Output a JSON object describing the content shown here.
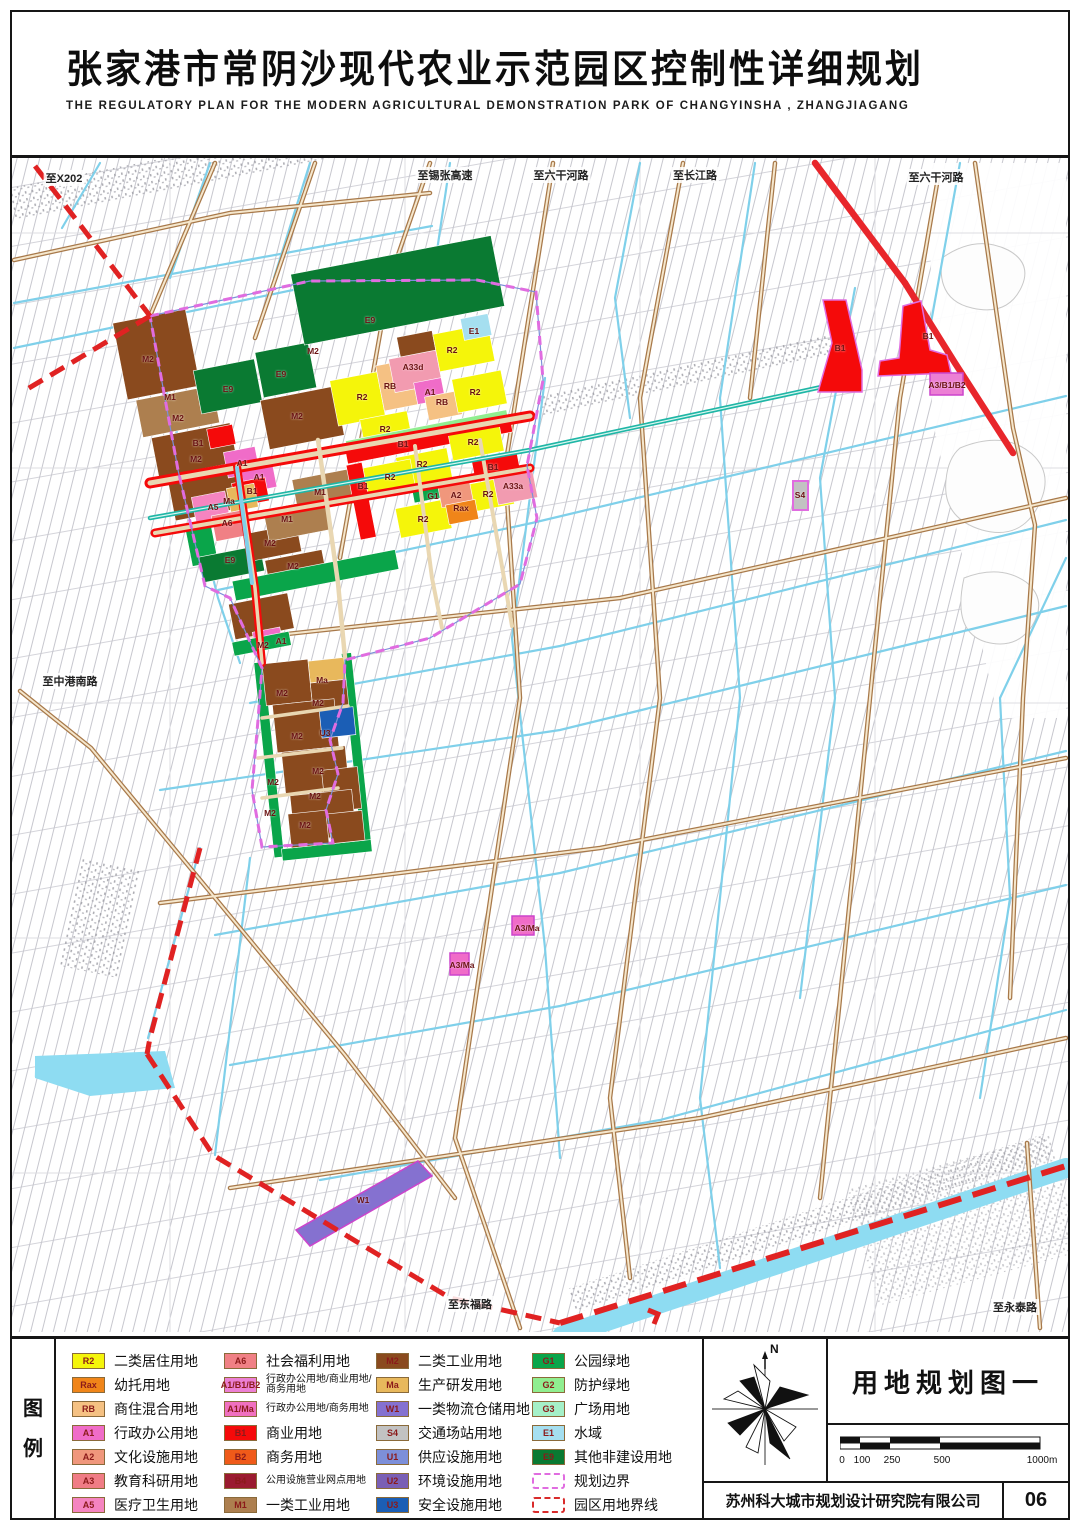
{
  "header": {
    "title_cn": "张家港市常阴沙现代农业示范园区控制性详细规划",
    "title_en": "THE REGULATORY PLAN FOR THE MODERN AGRICULTURAL DEMONSTRATION PARK OF CHANGYINSHA , ZHANGJIAGANG"
  },
  "colors": {
    "R2": "#F5F50A",
    "Rax": "#F08519",
    "RB": "#F5C183",
    "A1": "#F06CC8",
    "A2": "#F0977C",
    "A3": "#F07C85",
    "A5": "#F584C0",
    "A6": "#F08085",
    "A1B1B2": "#EC7FD4",
    "A1Ma": "#F070C0",
    "B1": "#F50A0A",
    "B2": "#F05A19",
    "B4": "#9B1B30",
    "M1": "#AD7F4F",
    "M2": "#8A4A1E",
    "Ma": "#E8B85C",
    "W1": "#8571D0",
    "S4": "#C2C2C2",
    "U1": "#7D8FD9",
    "U2": "#7A5FB5",
    "U3": "#1B5EB5",
    "G1": "#0AA54A",
    "G2": "#90EE90",
    "G3": "#A5F0C8",
    "E1": "#A5DFF0",
    "E9": "#0A7A32",
    "plan_boundary": "#E06CE0",
    "park_boundary": "#D92B2B"
  },
  "map": {
    "edge_labels": [
      {
        "t": "至X202",
        "x": 52,
        "y": 20
      },
      {
        "t": "至锡张高速",
        "x": 433,
        "y": 17
      },
      {
        "t": "至六干河路",
        "x": 549,
        "y": 17
      },
      {
        "t": "至长江路",
        "x": 683,
        "y": 17
      },
      {
        "t": "至六干河路",
        "x": 924,
        "y": 19
      },
      {
        "t": "至中港南路",
        "x": 58,
        "y": 523
      },
      {
        "t": "至东福路",
        "x": 458,
        "y": 1146
      },
      {
        "t": "至永泰路",
        "x": 1003,
        "y": 1149
      }
    ],
    "zone_labels": [
      {
        "t": "M2",
        "x": 136,
        "y": 201
      },
      {
        "t": "M1",
        "x": 158,
        "y": 239
      },
      {
        "t": "M2",
        "x": 166,
        "y": 260
      },
      {
        "t": "M2",
        "x": 184,
        "y": 301
      },
      {
        "t": "B1",
        "x": 186,
        "y": 285
      },
      {
        "t": "E9",
        "x": 216,
        "y": 231
      },
      {
        "t": "E9",
        "x": 269,
        "y": 216
      },
      {
        "t": "E9",
        "x": 358,
        "y": 162
      },
      {
        "t": "M2",
        "x": 301,
        "y": 193
      },
      {
        "t": "A33d",
        "x": 401,
        "y": 209
      },
      {
        "t": "R2",
        "x": 440,
        "y": 192
      },
      {
        "t": "E1",
        "x": 462,
        "y": 173
      },
      {
        "t": "M2",
        "x": 285,
        "y": 258
      },
      {
        "t": "R2",
        "x": 350,
        "y": 239
      },
      {
        "t": "RB",
        "x": 378,
        "y": 228
      },
      {
        "t": "R2",
        "x": 463,
        "y": 234
      },
      {
        "t": "RB",
        "x": 430,
        "y": 244
      },
      {
        "t": "A1",
        "x": 418,
        "y": 234
      },
      {
        "t": "R2",
        "x": 373,
        "y": 271
      },
      {
        "t": "B1",
        "x": 391,
        "y": 286
      },
      {
        "t": "R2",
        "x": 410,
        "y": 306
      },
      {
        "t": "R2",
        "x": 461,
        "y": 284
      },
      {
        "t": "B1",
        "x": 481,
        "y": 309
      },
      {
        "t": "R2",
        "x": 378,
        "y": 319
      },
      {
        "t": "A33a",
        "x": 501,
        "y": 328
      },
      {
        "t": "A2",
        "x": 444,
        "y": 337
      },
      {
        "t": "Rax",
        "x": 449,
        "y": 350
      },
      {
        "t": "R2",
        "x": 476,
        "y": 336
      },
      {
        "t": "R2",
        "x": 411,
        "y": 361
      },
      {
        "t": "M1",
        "x": 308,
        "y": 334
      },
      {
        "t": "M1",
        "x": 275,
        "y": 361
      },
      {
        "t": "Ma",
        "x": 217,
        "y": 343
      },
      {
        "t": "A5",
        "x": 201,
        "y": 349
      },
      {
        "t": "A6",
        "x": 215,
        "y": 365
      },
      {
        "t": "G1",
        "x": 421,
        "y": 338
      },
      {
        "t": "B1",
        "x": 351,
        "y": 328
      },
      {
        "t": "A1",
        "x": 230,
        "y": 305
      },
      {
        "t": "A1",
        "x": 247,
        "y": 319
      },
      {
        "t": "B1",
        "x": 240,
        "y": 333
      },
      {
        "t": "M2",
        "x": 258,
        "y": 385
      },
      {
        "t": "E9",
        "x": 218,
        "y": 402
      },
      {
        "t": "M2",
        "x": 281,
        "y": 408
      },
      {
        "t": "A1",
        "x": 269,
        "y": 483
      },
      {
        "t": "M2",
        "x": 251,
        "y": 487
      },
      {
        "t": "Ma",
        "x": 310,
        "y": 522
      },
      {
        "t": "M2",
        "x": 270,
        "y": 535
      },
      {
        "t": "M2",
        "x": 306,
        "y": 545
      },
      {
        "t": "M2",
        "x": 285,
        "y": 578
      },
      {
        "t": "U3",
        "x": 313,
        "y": 575
      },
      {
        "t": "M2",
        "x": 306,
        "y": 613
      },
      {
        "t": "M2",
        "x": 261,
        "y": 624
      },
      {
        "t": "M2",
        "x": 303,
        "y": 638
      },
      {
        "t": "M2",
        "x": 258,
        "y": 655
      },
      {
        "t": "M2",
        "x": 293,
        "y": 667
      },
      {
        "t": "S4",
        "x": 788,
        "y": 337
      },
      {
        "t": "B1",
        "x": 828,
        "y": 190
      },
      {
        "t": "B1",
        "x": 916,
        "y": 178
      },
      {
        "t": "A3/B1/B2",
        "x": 935,
        "y": 227
      },
      {
        "t": "A3/Ma",
        "x": 515,
        "y": 770
      },
      {
        "t": "A3/Ma",
        "x": 450,
        "y": 807
      },
      {
        "t": "W1",
        "x": 351,
        "y": 1042
      }
    ]
  },
  "legend": {
    "title": "图例",
    "columns": [
      [
        {
          "code": "R2",
          "type": "fill",
          "color": "#F5F50A",
          "label": "二类居住用地"
        },
        {
          "code": "Rax",
          "type": "fill",
          "color": "#F08519",
          "label": "幼托用地"
        },
        {
          "code": "RB",
          "type": "fill",
          "color": "#F5C183",
          "label": "商住混合用地"
        },
        {
          "code": "A1",
          "type": "fill",
          "color": "#F06CC8",
          "label": "行政办公用地"
        },
        {
          "code": "A2",
          "type": "fill",
          "color": "#F0977C",
          "label": "文化设施用地"
        },
        {
          "code": "A3",
          "type": "fill",
          "color": "#F07C85",
          "label": "教育科研用地"
        },
        {
          "code": "A5",
          "type": "fill",
          "color": "#F584C0",
          "label": "医疗卫生用地"
        }
      ],
      [
        {
          "code": "A6",
          "type": "fill",
          "color": "#F08085",
          "label": "社会福利用地"
        },
        {
          "code": "A1/B1/B2",
          "type": "fill",
          "color": "#EC7FD4",
          "label": "行政办公用地/商业用地/商务用地",
          "small": true
        },
        {
          "code": "A1/Ma",
          "type": "fill",
          "color": "#F070C0",
          "label": "行政办公用地/商务用地",
          "small": true
        },
        {
          "code": "B1",
          "type": "fill",
          "color": "#F50A0A",
          "label": "商业用地"
        },
        {
          "code": "B2",
          "type": "fill",
          "color": "#F05A19",
          "label": "商务用地"
        },
        {
          "code": "B4",
          "type": "fill",
          "color": "#9B1B30",
          "label": "公用设施营业网点用地",
          "small": true
        },
        {
          "code": "M1",
          "type": "fill",
          "color": "#AD7F4F",
          "label": "一类工业用地"
        }
      ],
      [
        {
          "code": "M2",
          "type": "fill",
          "color": "#8A4A1E",
          "label": "二类工业用地"
        },
        {
          "code": "Ma",
          "type": "fill",
          "color": "#E8B85C",
          "label": "生产研发用地"
        },
        {
          "code": "W1",
          "type": "fill",
          "color": "#8571D0",
          "label": "一类物流仓储用地"
        },
        {
          "code": "S4",
          "type": "fill",
          "color": "#C2C2C2",
          "label": "交通场站用地"
        },
        {
          "code": "U1",
          "type": "fill",
          "color": "#7D8FD9",
          "label": "供应设施用地"
        },
        {
          "code": "U2",
          "type": "fill",
          "color": "#7A5FB5",
          "label": "环境设施用地"
        },
        {
          "code": "U3",
          "type": "fill",
          "color": "#1B5EB5",
          "label": "安全设施用地"
        }
      ],
      [
        {
          "code": "G1",
          "type": "fill",
          "color": "#0AA54A",
          "label": "公园绿地"
        },
        {
          "code": "G2",
          "type": "fill",
          "color": "#90EE90",
          "label": "防护绿地"
        },
        {
          "code": "G3",
          "type": "fill",
          "color": "#A5F0C8",
          "label": "广场用地"
        },
        {
          "code": "E1",
          "type": "fill",
          "color": "#A5DFF0",
          "label": "水域"
        },
        {
          "code": "E9",
          "type": "fill",
          "color": "#0A7A32",
          "label": "其他非建设用地"
        },
        {
          "code": "",
          "type": "dash-magenta",
          "color": "#E06CE0",
          "label": "规划边界"
        },
        {
          "code": "",
          "type": "dash-red",
          "color": "#D92B2B",
          "label": "园区用地界线"
        }
      ]
    ]
  },
  "titleblock": {
    "compass_label": "N",
    "plan_title": "用地规划图一",
    "scale_ticks": [
      "0",
      "100",
      "250",
      "500",
      "1000m"
    ],
    "company": "苏州科大城市规划设计研究院有限公司",
    "page_no": "06"
  }
}
